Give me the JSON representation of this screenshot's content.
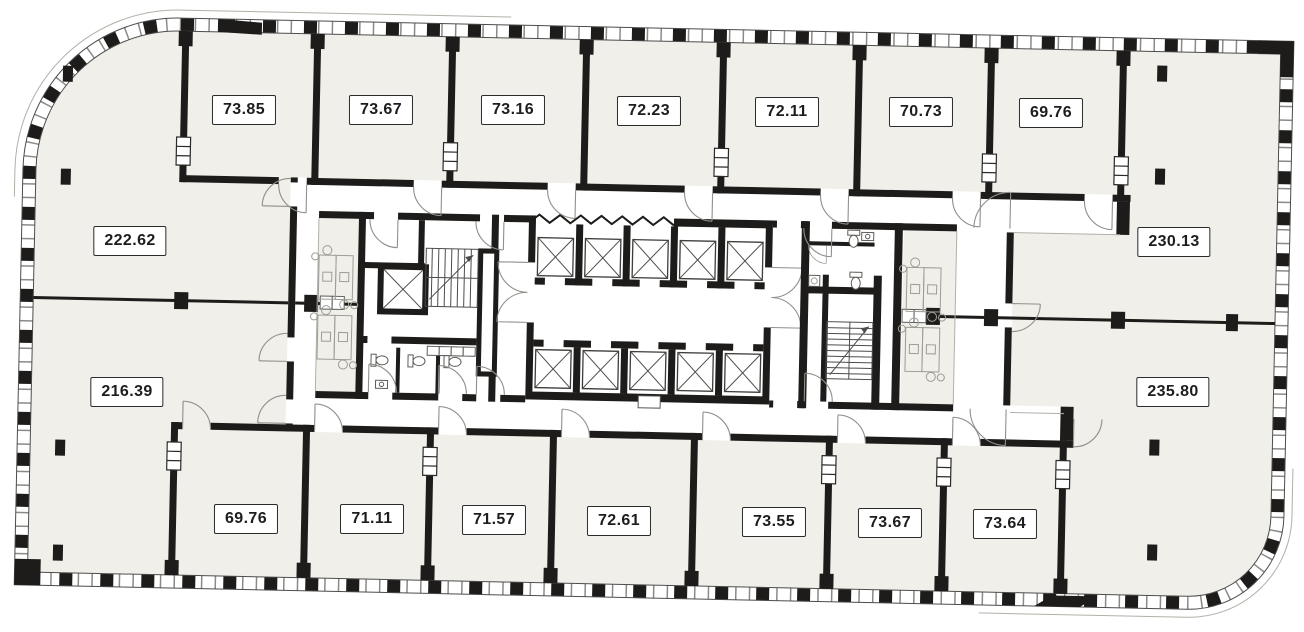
{
  "floor_plan": {
    "type": "office-floor-plan",
    "rooms_top": [
      {
        "area": "73.85"
      },
      {
        "area": "73.67"
      },
      {
        "area": "73.16"
      },
      {
        "area": "72.23"
      },
      {
        "area": "72.11"
      },
      {
        "area": "70.73"
      },
      {
        "area": "69.76"
      }
    ],
    "rooms_left": [
      {
        "area": "222.62"
      },
      {
        "area": "216.39"
      }
    ],
    "rooms_right": [
      {
        "area": "230.13"
      },
      {
        "area": "235.80"
      }
    ],
    "rooms_bottom": [
      {
        "area": "69.76"
      },
      {
        "area": "71.11"
      },
      {
        "area": "71.57"
      },
      {
        "area": "72.61"
      },
      {
        "area": "73.55"
      },
      {
        "area": "73.67"
      },
      {
        "area": "73.64"
      }
    ],
    "colors": {
      "room_fill": "#f0efe9",
      "corridor_fill": "#ffffff",
      "wall": "#1d1c1a",
      "label_border": "#2b2b2b",
      "label_text": "#1d1d1d",
      "furniture_line": "#9d9d98"
    }
  }
}
